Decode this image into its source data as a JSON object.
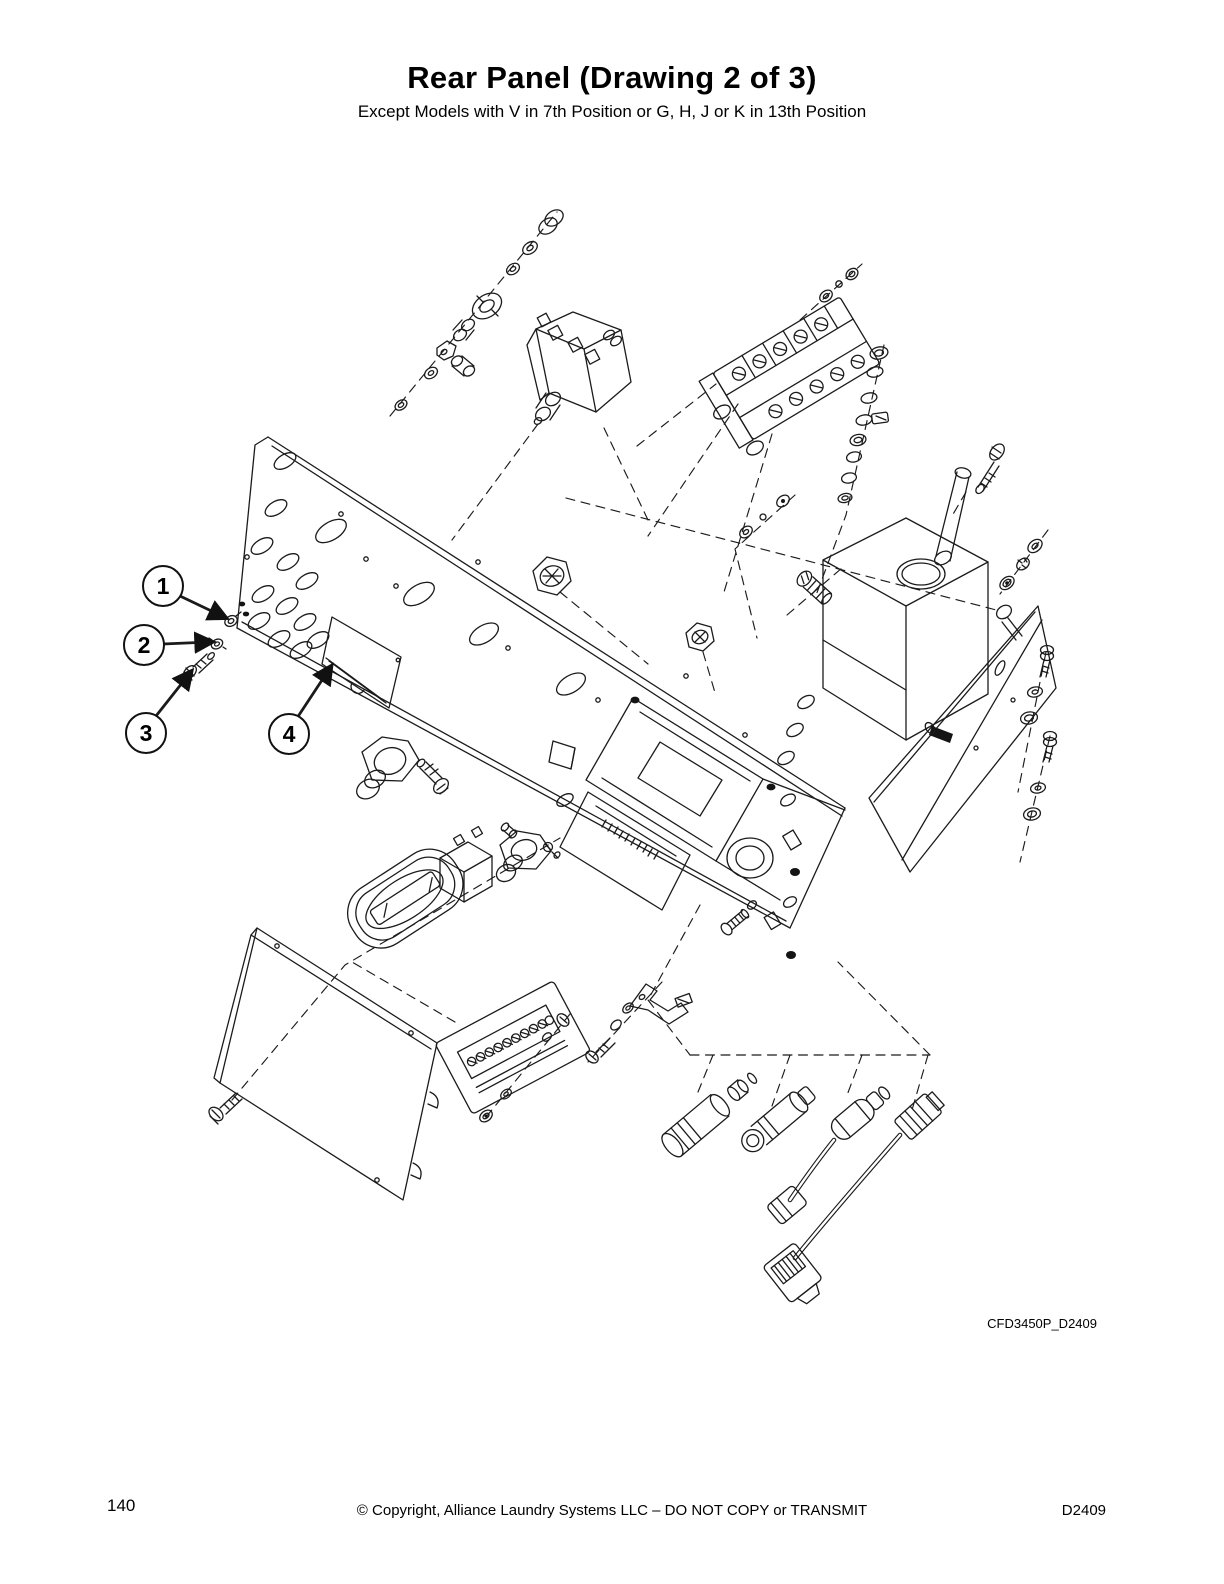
{
  "header": {
    "title": "Rear Panel (Drawing 2 of 3)",
    "subtitle": "Except Models with V in 7th Position or G, H, J or K in 13th Position"
  },
  "diagram": {
    "drawing_code": "CFD3450P_D2409",
    "line_color": "#1b1b1b",
    "callouts": [
      {
        "label": "1"
      },
      {
        "label": "2"
      },
      {
        "label": "3"
      },
      {
        "label": "4"
      }
    ]
  },
  "footer": {
    "page_number": "140",
    "copyright": "© Copyright, Alliance Laundry Systems LLC – DO NOT COPY or TRANSMIT",
    "doc_code": "D2409"
  }
}
